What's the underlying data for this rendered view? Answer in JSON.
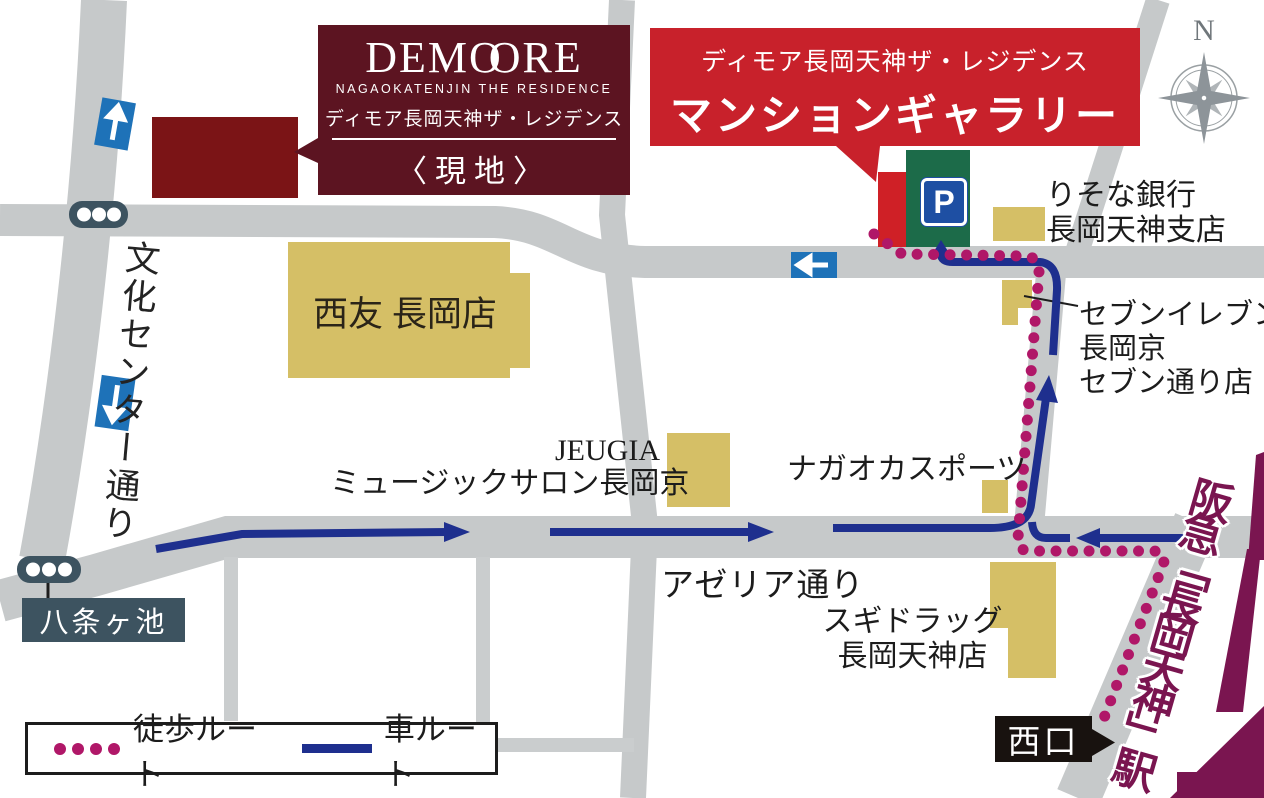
{
  "colors": {
    "road": "#c6c9ca",
    "road2": "#cacdce",
    "bldg": "#d5bf66",
    "maroon": "#5c1421",
    "site_bldg": "#7b1416",
    "red": "#c8212b",
    "gallery_bldg": "#cf2026",
    "green": "#1c6b49",
    "psign": "#1e4fa3",
    "sign": "#1e72b8",
    "car": "#1e2f8e",
    "walk": "#b01768",
    "purple": "#7a1550",
    "slate": "#3d5360"
  },
  "demoore_banner": {
    "logo_parts": [
      "DEM",
      "O",
      "O",
      "RE"
    ],
    "logo_sub": "NAGAOKATENJIN THE RESIDENCE",
    "name_jp": "ディモア長岡天神ザ・レジデンス",
    "site": "〈現地〉"
  },
  "gallery_banner": {
    "name_jp": "ディモア長岡天神ザ・レジデンス",
    "title": "マンションギャラリー"
  },
  "compass": {
    "north": "N"
  },
  "labels": {
    "seiyu": "西友 長岡店",
    "risona_1": "りそな銀行",
    "risona_2": "長岡天神支店",
    "seven_1": "セブンイレブン",
    "seven_2": "長岡京",
    "seven_3": "セブン通り店",
    "jeugia_1": "JEUGIA",
    "jeugia_2": "ミュージックサロン長岡京",
    "sports": "ナガオカスポーツ",
    "azeria": "アゼリア通り",
    "sugi_1": "スギドラッグ",
    "sugi_2": "長岡天神店",
    "bunka": "文化センター通り",
    "hachijo": "八条ヶ池",
    "nishiguchi": "西口",
    "station": "阪急「長岡天神」駅",
    "parking": "P"
  },
  "legend": {
    "walk": "徒歩ルート",
    "car": "車ルート"
  }
}
